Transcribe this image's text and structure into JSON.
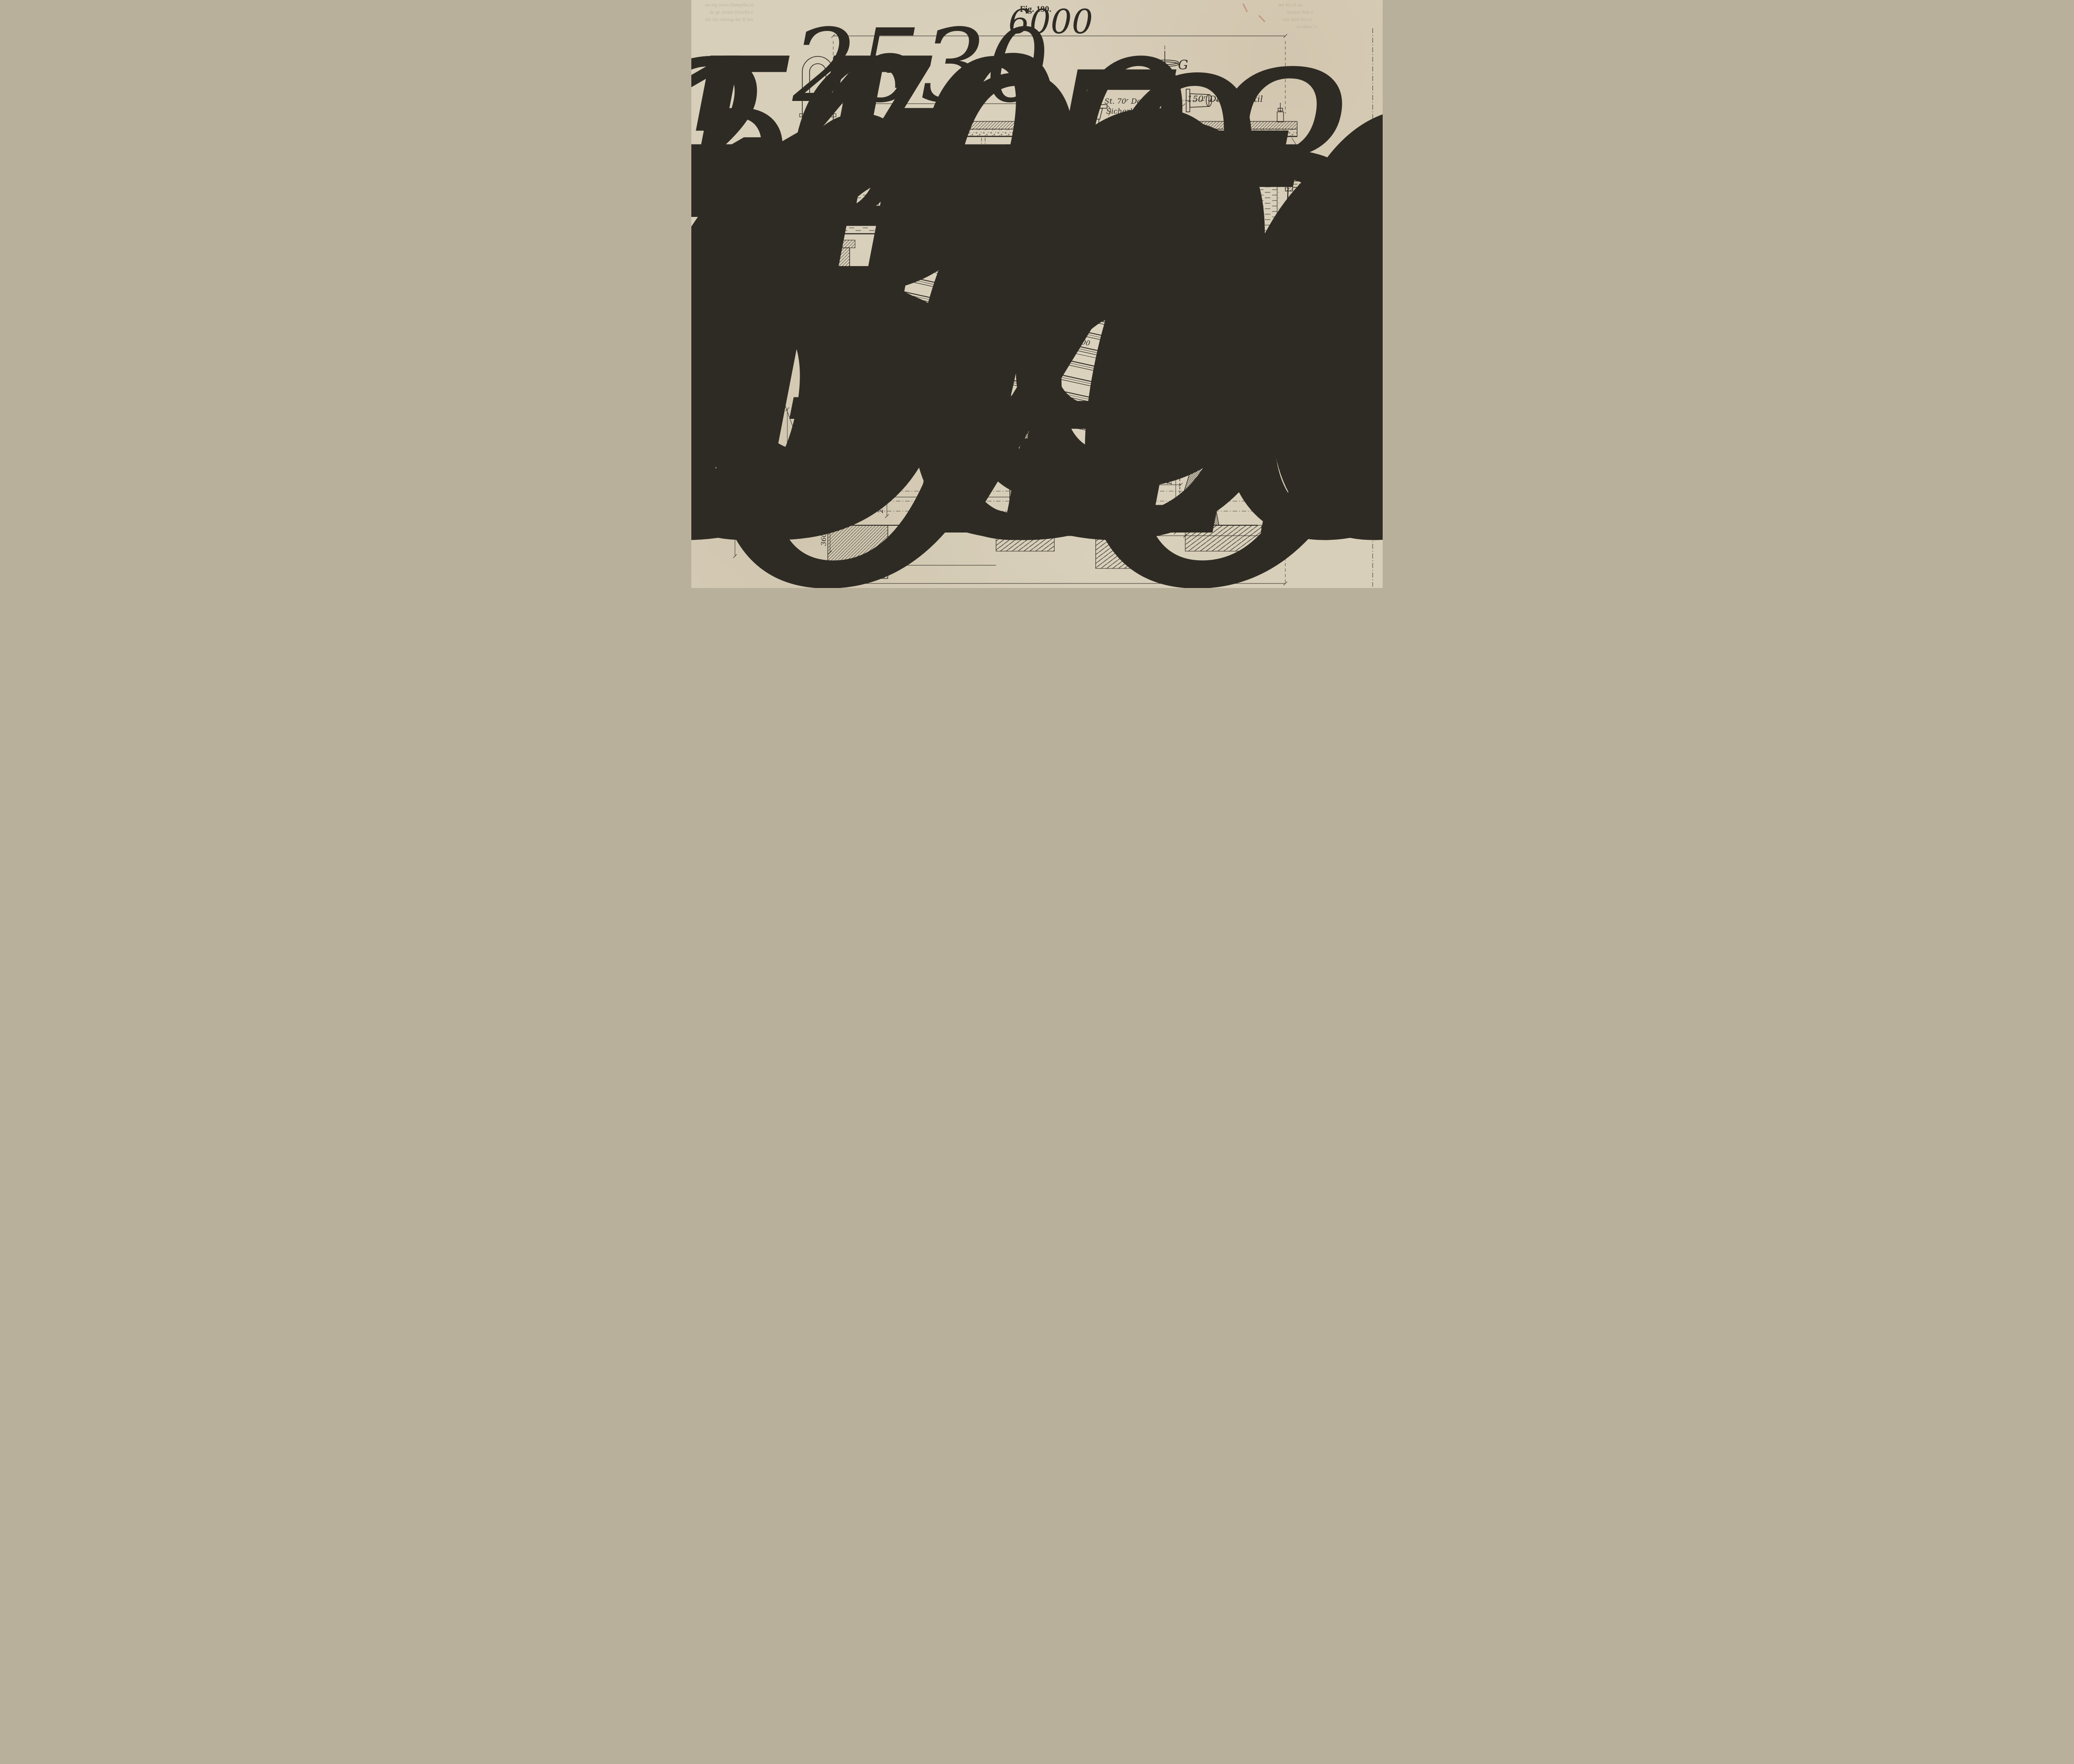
{
  "figure": {
    "title": "Fig. 190."
  },
  "letters": {
    "top_left": "B",
    "steam_valve": "G",
    "bottom_left": "G",
    "bottom_right": "G"
  },
  "labels": {
    "steam_valve": "150ʳ Dampfventil",
    "safety_valve_line1": "2 St. 70ʳ Doppel-",
    "safety_valve_line2": "Sicherheitsven.",
    "water_level": "Niedrigster - Wasserstand",
    "tube_bundles": "20 Rohrbündel à 30 Rohre",
    "blowoff_top": "50ʳ Ausblaseventil",
    "blowoff_bottom": "50ʳ Ausblaseventil",
    "tube_od_note": "89 äuss. ø"
  },
  "dims": {
    "d6000_top": "6000",
    "d2530": "2530",
    "d300x400": "300 x 400",
    "d20_plate": "20",
    "d170": "170",
    "d1400": "1400",
    "d18": "18",
    "d1100": "1100",
    "d570": "570",
    "d1600": "1600",
    "d6a": "6",
    "d6b": "6",
    "d240": "240",
    "d260_ledge": "260",
    "d950": "950",
    "d500_uptake": "500",
    "d400_uptake": "400",
    "d20_wall": "20",
    "d194_wall": "194",
    "d1000_a": "1000",
    "d1000_b": "1000",
    "d1000_c": "1000",
    "d1000_d": "1000",
    "d30": "30",
    "d1125": "1125",
    "d400_tube": "400",
    "d1450": "1450",
    "d300_mid": "300",
    "d89": "89",
    "d194_right": "194",
    "d20_right": "20",
    "d1560": "1560",
    "d580": "580",
    "d380_wall": "380",
    "d350x500": "350 x 500",
    "d2100": "2100",
    "d750": "750",
    "d830": "830",
    "d250": "250",
    "d500_flue_c": "500",
    "d260_c": "260",
    "d260_left": "260",
    "d500_flue_r": "500",
    "d350_flue_r": "350",
    "d360": "360",
    "d120x80": "120 x 80",
    "d550_drum": "550",
    "d720": "720",
    "d5170": "5170",
    "d4575": "4575",
    "d1920": "1920",
    "d1475": "1475",
    "d770": "770",
    "d550_f1": "550",
    "d640": "640",
    "d550_f2": "550",
    "d1010": "1010",
    "d6000_bottom": "6000"
  },
  "palette": {
    "paper": "#d8cfba",
    "ink": "#2e2b24",
    "accent_mark": "#b4705a"
  }
}
